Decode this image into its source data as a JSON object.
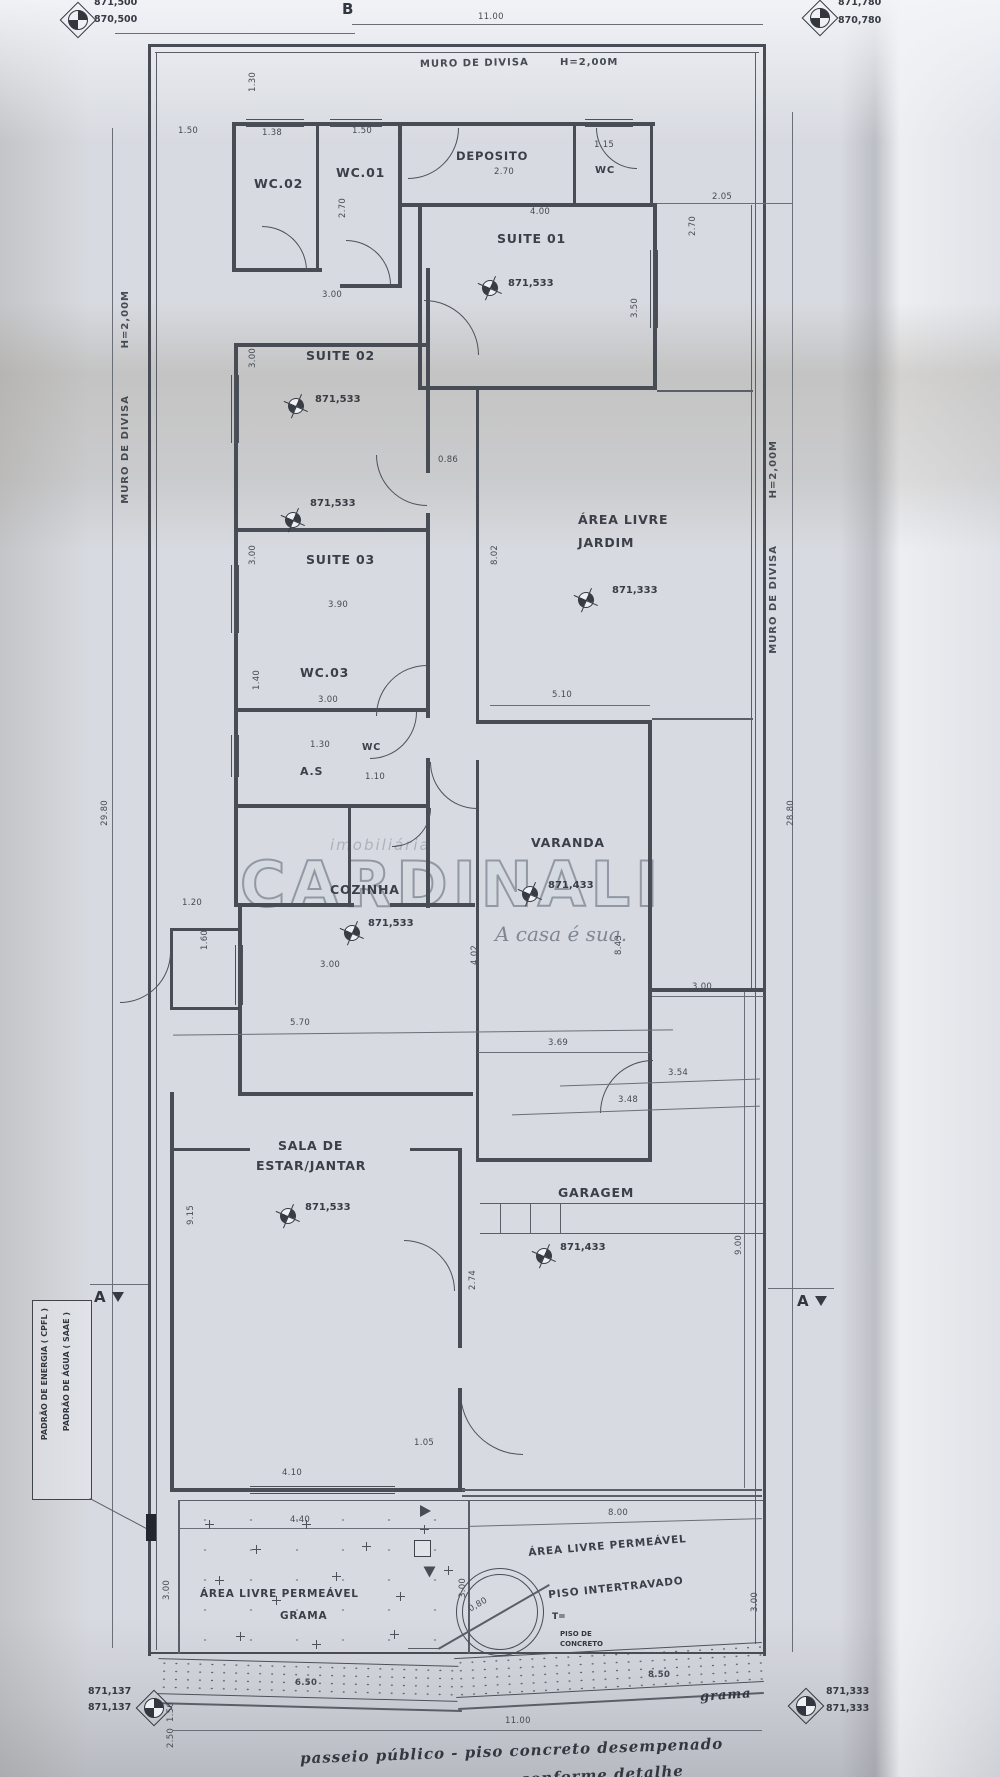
{
  "benchmarks": {
    "top_left": {
      "l1": "871,500",
      "l2": "870,500"
    },
    "top_right": {
      "l1": "871,780",
      "l2": "870,780"
    },
    "bottom_left": {
      "l1": "871,137",
      "l2": "871,137"
    },
    "bottom_right": {
      "l1": "871,333",
      "l2": "871,333"
    }
  },
  "boundary": {
    "muro_top": "MURO DE DIVISA",
    "muro_top_h": "H=2,00M",
    "muro_left": "MURO DE DIVISA",
    "muro_left_h": "H=2,00M",
    "muro_right": "MURO DE DIVISA",
    "muro_right_h": "H=2,00M"
  },
  "sections": {
    "b_top": "B",
    "a_left": "A",
    "a_right": "A"
  },
  "rooms": {
    "wc02": {
      "name": "WC.02"
    },
    "wc01": {
      "name": "WC.01"
    },
    "deposito": {
      "name": "DEPOSITO",
      "dim": "2.70"
    },
    "wc_top": {
      "name": "WC",
      "dim": "1.15"
    },
    "suite01": {
      "name": "SUITE 01",
      "level": "871,533"
    },
    "suite02": {
      "name": "SUITE 02",
      "level": "871,533"
    },
    "suite03": {
      "name": "SUITE 03",
      "level": "871,533"
    },
    "wc03": {
      "name": "WC.03"
    },
    "area_servico": {
      "name": "A.S"
    },
    "wc_mid": {
      "name": "WC",
      "dim": "1.10"
    },
    "cozinha": {
      "name": "COZINHA",
      "level": "871,533"
    },
    "jardim": {
      "line1": "ÁREA LIVRE",
      "line2": "JARDIM",
      "level": "871,333"
    },
    "varanda": {
      "name": "VARANDA",
      "level": "871,433"
    },
    "sala": {
      "line1": "SALA DE",
      "line2": "ESTAR/JANTAR",
      "level": "871,533"
    },
    "garagem": {
      "name": "GARAGEM",
      "level": "871,433"
    },
    "grama": {
      "line1": "ÁREA LIVRE PERMEÁVEL",
      "line2": "GRAMA"
    },
    "intertravado": {
      "line1": "ÁREA LIVRE PERMEÁVEL",
      "line2": "PISO INTERTRAVADO"
    }
  },
  "dims": {
    "top_width": "11.00",
    "top_offset": "1.30",
    "wc02_off": "1.50",
    "wc02_w": "1.38",
    "wc01_w": "1.50",
    "wc_depth_l": "2.70",
    "wc_depth_r": "2.70",
    "suite01_w": "4.00",
    "suite01_d": "3.50",
    "right_gap": "2.05",
    "suite02_w": "3.00",
    "suite02_d": "3.00",
    "gap_suites": "0.86",
    "suite03_d": "3.00",
    "suite03_w": "3.90",
    "wc03_d": "1.40",
    "wc03_w": "3.00",
    "as_w": "1.30",
    "jardim_d": "8.02",
    "jardim_w": "5.10",
    "coz_off1": "1.20",
    "coz_off2": "1.60",
    "coz_w": "3.00",
    "sala_top_w": "5.70",
    "sala_d": "9.15",
    "sala_w": "4.10",
    "sala_step": "1.05",
    "var_left_d": "4.02",
    "var_right_d": "8.43",
    "var_w": "3.69",
    "entry_w": "3.00",
    "entry_s1": "3.54",
    "entry_s2": "3.48",
    "entry_v": "2.74",
    "gar_d": "9.00",
    "porch_w": "4.40",
    "inter_w": "8.00",
    "grama_d": "3.00",
    "mid_d": "3.00",
    "inter_d": "3.00",
    "walk_left": "6.50",
    "walk_right": "8.50",
    "bottom_width": "11.00",
    "walk_o1": "1.50",
    "walk_o2": "2.50",
    "left_total": "29.80",
    "right_total": "28.80",
    "tree_r": "0,80"
  },
  "annotations": {
    "padrao1": "PADRÃO DE ENERGIA ( CPFL )",
    "padrao2": "PADRÃO DE ÁGUA ( SAAE )",
    "passeio": "passeio público - piso concreto desempenado",
    "passeio2": "conforme detalhe",
    "grama_note": "grama",
    "tree_t": "T=",
    "tree_n1": "PISO DE",
    "tree_n2": "CONCRETO"
  },
  "watermark": {
    "small": "imobiliária",
    "brand": "CARDINALI",
    "tagline": "A casa é sua."
  }
}
